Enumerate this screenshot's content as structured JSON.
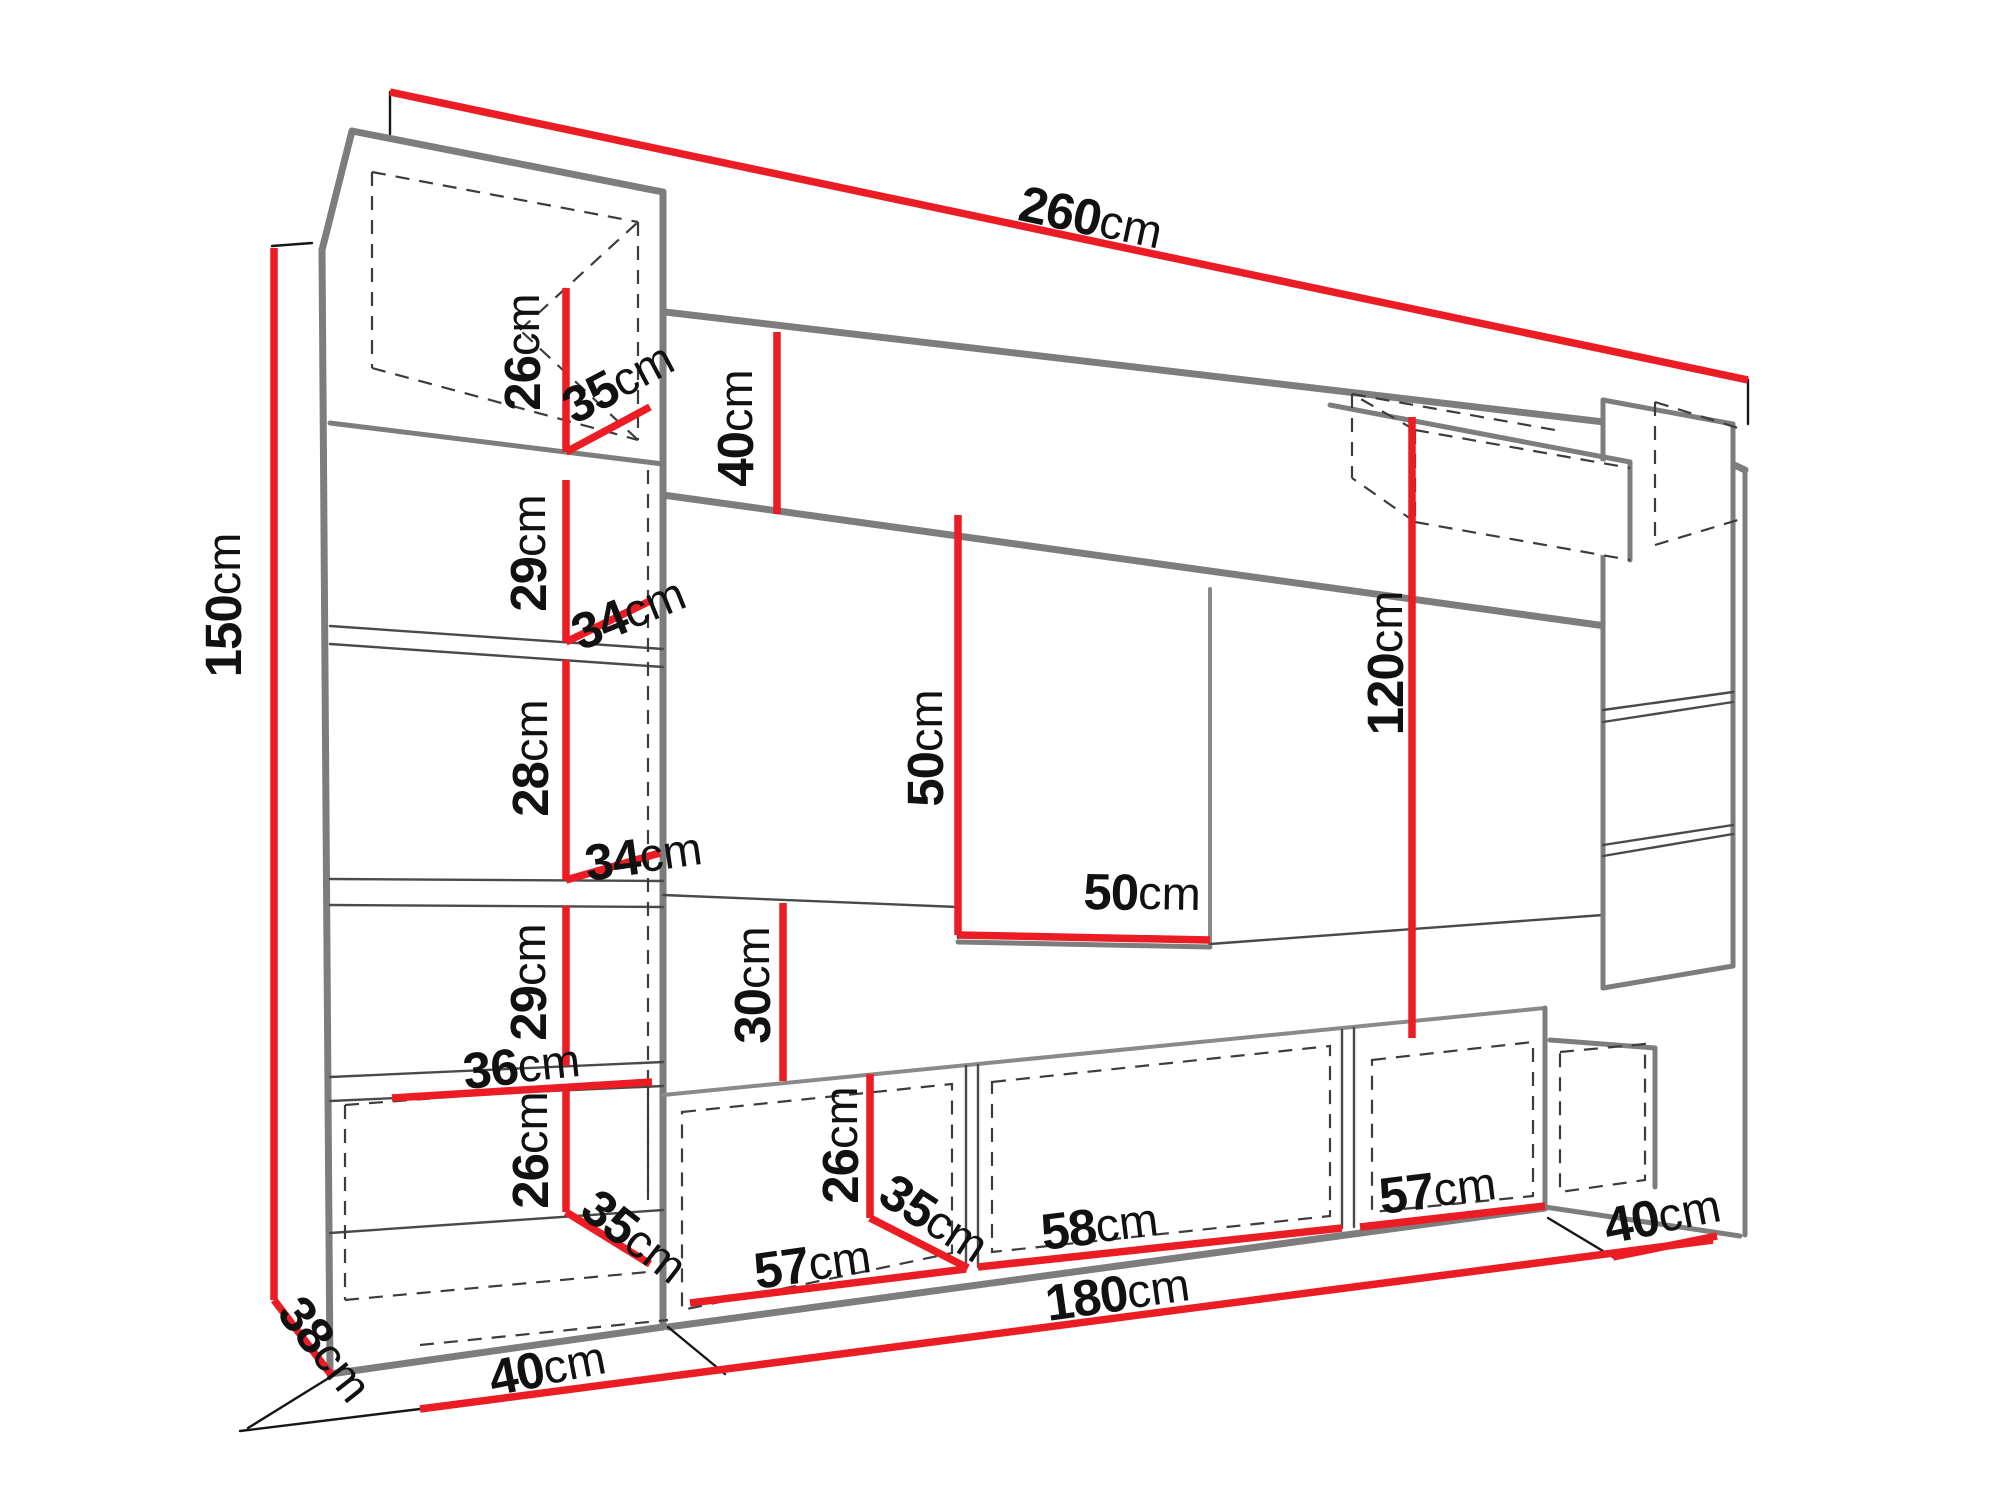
{
  "page": {
    "background": "#ffffff",
    "description_of_content": "Technical dimension drawing of a living-room wall unit (entertainment center) in perspective with red dimension lines"
  },
  "colors": {
    "dimension_red": "#ec1c24",
    "structure_gray": "#7d7d7d",
    "detail_line": "#4a4a4a"
  },
  "diagram": {
    "type": "furniture-dimension-drawing",
    "unit": "cm",
    "overall": {
      "width": "260",
      "height": "150",
      "depth": "38"
    },
    "dimension_labels": [
      {
        "id": "total-width",
        "value": "260",
        "x": 1090,
        "y": 222,
        "rotation": 12
      },
      {
        "id": "total-height",
        "value": "150",
        "x": 228,
        "y": 605,
        "rotation": -90
      },
      {
        "id": "left-cube-height",
        "value": "26",
        "x": 527,
        "y": 352,
        "rotation": -90
      },
      {
        "id": "left-cube-width",
        "value": "35",
        "x": 620,
        "y": 386,
        "rotation": -28
      },
      {
        "id": "top-beam-height",
        "value": "40",
        "x": 740,
        "y": 428,
        "rotation": -90
      },
      {
        "id": "left-opening-1-height",
        "value": "29",
        "x": 533,
        "y": 553,
        "rotation": -90
      },
      {
        "id": "left-shelf-1-depth",
        "value": "34",
        "x": 630,
        "y": 617,
        "rotation": -22
      },
      {
        "id": "left-opening-2-height",
        "value": "28",
        "x": 535,
        "y": 758,
        "rotation": -90
      },
      {
        "id": "left-shelf-2-depth",
        "value": "34",
        "x": 644,
        "y": 860,
        "rotation": -8
      },
      {
        "id": "left-opening-3-height",
        "value": "29",
        "x": 533,
        "y": 982,
        "rotation": -90
      },
      {
        "id": "left-base-inner-width",
        "value": "36",
        "x": 522,
        "y": 1070,
        "rotation": -6
      },
      {
        "id": "left-base-height",
        "value": "26",
        "x": 535,
        "y": 1150,
        "rotation": -90
      },
      {
        "id": "left-base-depth",
        "value": "35",
        "x": 632,
        "y": 1240,
        "rotation": 38
      },
      {
        "id": "total-depth",
        "value": "38",
        "x": 322,
        "y": 1352,
        "rotation": 52
      },
      {
        "id": "left-base-floor-width",
        "value": "40",
        "x": 548,
        "y": 1372,
        "rotation": -11
      },
      {
        "id": "tv-niche-height",
        "value": "50",
        "x": 930,
        "y": 748,
        "rotation": -90
      },
      {
        "id": "tv-niche-width",
        "value": "50",
        "x": 1142,
        "y": 897,
        "rotation": 1
      },
      {
        "id": "middle-gap-height",
        "value": "30",
        "x": 757,
        "y": 985,
        "rotation": -90
      },
      {
        "id": "bottom-cabinet-height",
        "value": "26",
        "x": 845,
        "y": 1145,
        "rotation": -90
      },
      {
        "id": "bottom-cabinet-depth",
        "value": "35",
        "x": 932,
        "y": 1222,
        "rotation": 33
      },
      {
        "id": "bottom-cabinet-1-width",
        "value": "57",
        "x": 813,
        "y": 1268,
        "rotation": -8
      },
      {
        "id": "bottom-cabinet-2-width",
        "value": "58",
        "x": 1100,
        "y": 1230,
        "rotation": -7
      },
      {
        "id": "bottom-row-width",
        "value": "180",
        "x": 1118,
        "y": 1298,
        "rotation": -8
      },
      {
        "id": "bottom-cabinet-3-width",
        "value": "57",
        "x": 1438,
        "y": 1194,
        "rotation": -7
      },
      {
        "id": "right-column-height",
        "value": "120",
        "x": 1390,
        "y": 663,
        "rotation": -90
      },
      {
        "id": "right-base-floor-width",
        "value": "40",
        "x": 1663,
        "y": 1220,
        "rotation": -11
      }
    ]
  }
}
